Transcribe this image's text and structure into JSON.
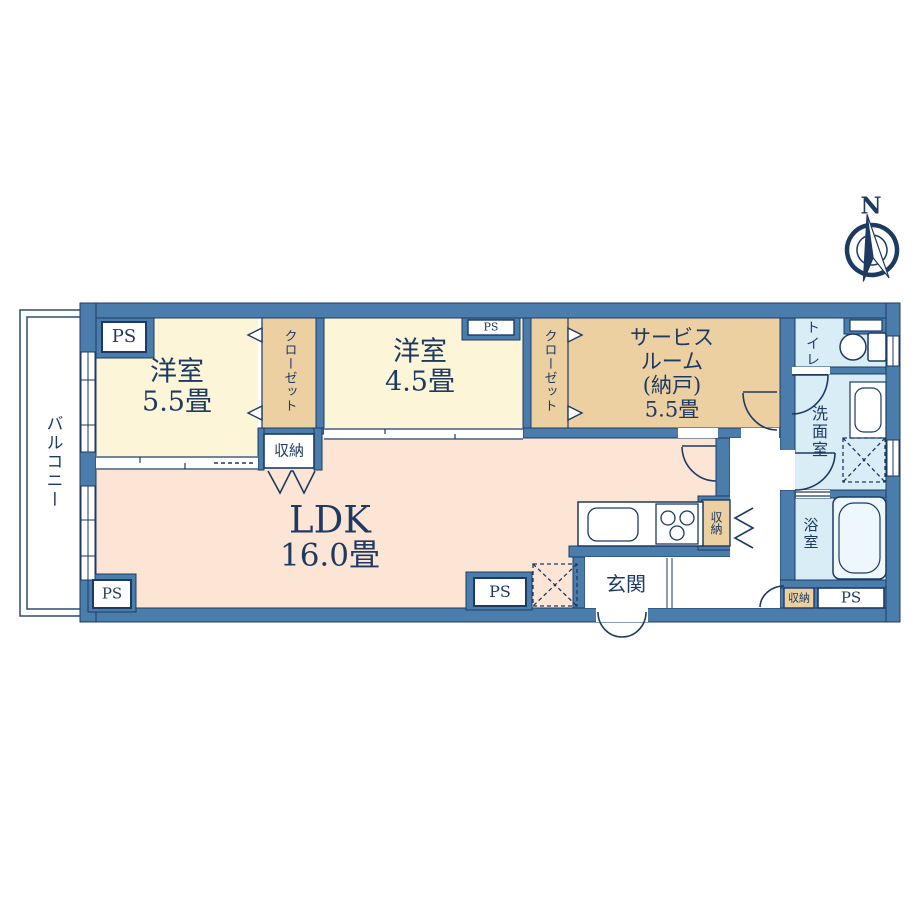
{
  "compass": {
    "north": "N"
  },
  "plan": {
    "balcony": "バルコニー",
    "bedroom1": {
      "name": "洋室",
      "size": "5.5畳"
    },
    "bedroom2": {
      "name": "洋室",
      "size": "4.5畳"
    },
    "service_room": {
      "line1": "サービス",
      "line2": "ルーム",
      "line3": "(納戸)",
      "line4": "5.5畳"
    },
    "ldk": {
      "name": "LDK",
      "size": "16.0畳"
    },
    "entrance": "玄関",
    "toilet": "トイレ",
    "washroom": "洗面室",
    "bathroom": "浴室",
    "closet": "クローゼット",
    "storage": "収納",
    "pipe_space": "PS"
  },
  "colors": {
    "wall": "#4a7dab",
    "wall_line": "#1c3c60",
    "bedroom_fill": "#fdf5d8",
    "closet_fill": "#ecd0a2",
    "ldk_fill": "#fce5d4",
    "wet_fill": "#d9edf6",
    "ink": "#1d3a63"
  }
}
